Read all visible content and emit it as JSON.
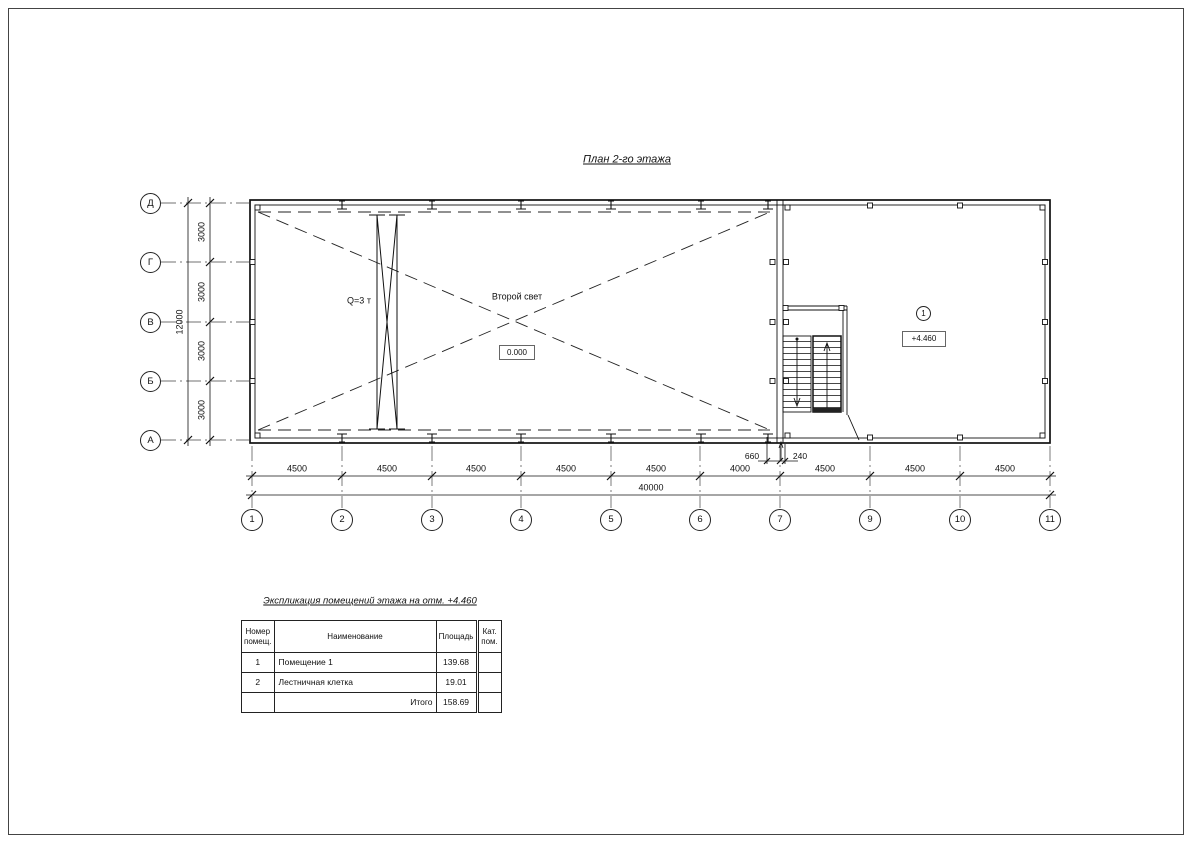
{
  "sheet": {
    "title": "План 2-го этажа"
  },
  "axes": {
    "columns": [
      "1",
      "2",
      "3",
      "4",
      "5",
      "6",
      "7",
      "9",
      "10",
      "11"
    ],
    "rows": [
      "Д",
      "Г",
      "В",
      "Б",
      "А"
    ]
  },
  "dims": {
    "bottom_segments": [
      "4500",
      "4500",
      "4500",
      "4500",
      "4500",
      "4000",
      "4500",
      "4500",
      "4500"
    ],
    "bottom_total": "40000",
    "left_segments": [
      "3000",
      "3000",
      "3000",
      "3000"
    ],
    "left_total": "12000",
    "door_left": "660",
    "door_right": "240"
  },
  "plan": {
    "crane_label": "Q=3 т",
    "void_label": "Второй свет",
    "level_zero": "0.000",
    "room_number": "1",
    "level_second": "+4.460"
  },
  "table": {
    "title": "Экспликация помещений этажа на отм. +4.460",
    "headers": {
      "number": "Номер помещ.",
      "name": "Наименование",
      "area": "Площадь",
      "cat": "Кат. пом."
    },
    "rows": [
      {
        "number": "1",
        "name": "Помещение 1",
        "area": "139.68",
        "cat": ""
      },
      {
        "number": "2",
        "name": "Лестничная клетка",
        "area": "19.01",
        "cat": ""
      },
      {
        "number": "",
        "name": "Итого",
        "area": "158.69",
        "cat": ""
      }
    ]
  }
}
